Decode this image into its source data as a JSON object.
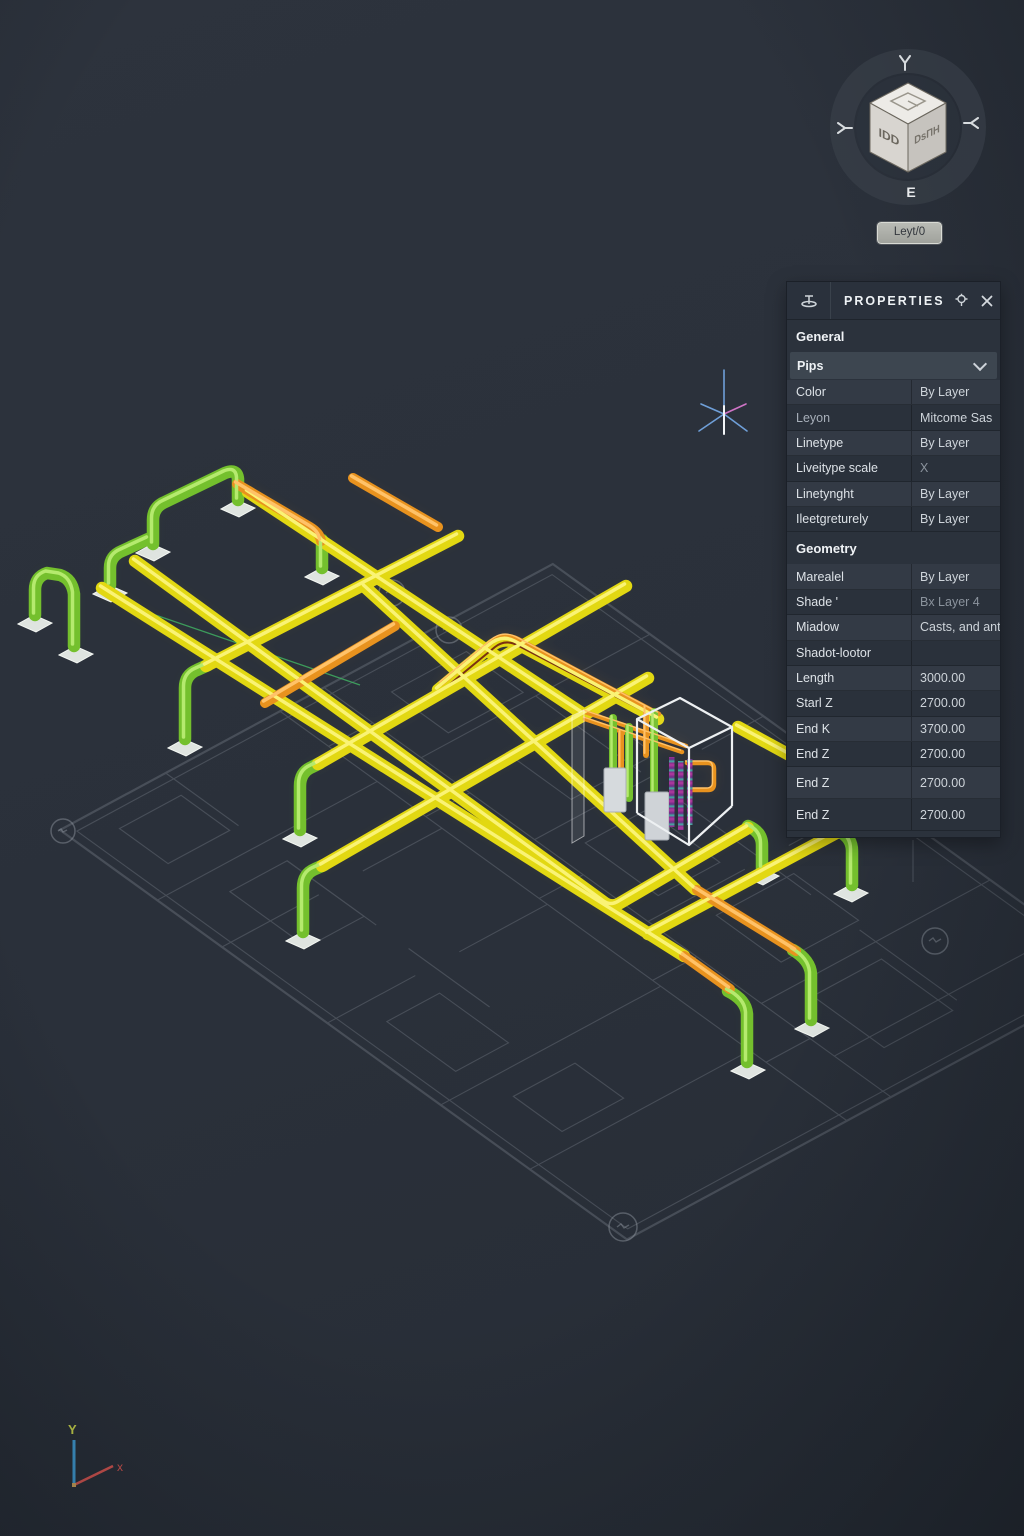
{
  "viewcube": {
    "left_face_label": "IDD",
    "right_face_label": "DsПH",
    "compass_south_label": "E",
    "layout_button_label": "Leyt/0"
  },
  "ucs_icon": {
    "y_axis_label": "Y",
    "x_axis_label": "x"
  },
  "colors": {
    "pipe_yellow": "#e2d812",
    "pipe_green": "#74c02d",
    "pipe_orange": "#e8921e",
    "equipment_magenta": "#b23a9e",
    "selection_wireframe": "#edf0f2",
    "panel_background": "#2b323c",
    "canvas_background": "#2a303a"
  },
  "icons": {
    "panel_pin": "pin-shape",
    "panel_settings": "gear-pin-shape",
    "panel_close": "x-shape",
    "selector_chevron": "chevron-down-shape"
  },
  "properties_panel": {
    "title": "PROPERTIES",
    "general_section_label": "General",
    "object_selector": {
      "label": "Pips"
    },
    "general_rows": [
      {
        "label": "Color",
        "value": "By Layer"
      },
      {
        "label": "Leyon",
        "value": "Mitcome Sas"
      },
      {
        "label": "Linetype",
        "value": "By Layer"
      },
      {
        "label": "Liveitype scale",
        "value": "X"
      },
      {
        "label": "Linetynght",
        "value": "By Layer"
      },
      {
        "label": "Ileetgreturely",
        "value": "By Layer"
      }
    ],
    "geometry_section_label": "Geometry",
    "geometry_rows": [
      {
        "label": "Marealel",
        "value": "By Layer"
      },
      {
        "label": "Shade '",
        "value": "Bx Layer 4"
      },
      {
        "label": "Miadow",
        "value": "Casts, and ant"
      },
      {
        "label": "Shadot-lootor",
        "value": ""
      },
      {
        "label": "Length",
        "value": "3000.00"
      },
      {
        "label": "Starl Z",
        "value": "2700.00"
      },
      {
        "label": "End K",
        "value": "3700.00"
      },
      {
        "label": "End Z",
        "value": "2700.00"
      },
      {
        "label": "End Z2",
        "value": "2700.00",
        "display_label": "End Z"
      },
      {
        "label": "End Z3",
        "value": "2700.00",
        "display_label": "End Z"
      }
    ]
  }
}
